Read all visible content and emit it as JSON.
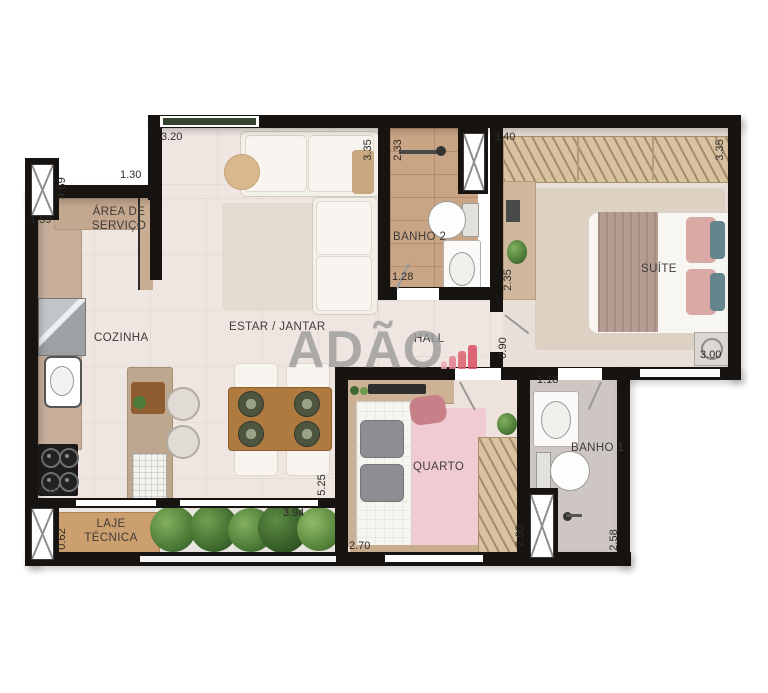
{
  "watermark": {
    "text": "ADÃO",
    "logo": "bar-chart-logo"
  },
  "rooms": {
    "area_servico": "ÁREA DE SERVIÇO",
    "cozinha": "COZINHA",
    "estar_jantar": "ESTAR / JANTAR",
    "hall": "HALL",
    "banho2": "BANHO 2",
    "suite": "SUÍTE",
    "quarto": "QUARTO",
    "banho1": "BANHO 1",
    "laje_tecnica": "LAJE TÉCNICA"
  },
  "dims": {
    "estar_top": "3.20",
    "servico_top": "1.30",
    "servico_left_v": "4.69",
    "servico_left": "1.59",
    "banho2_left_v": "2.33",
    "estar_right_v": "3.35",
    "suite_top": "3.40",
    "suite_right_v": "3.35",
    "banho2_bottom": "1.28",
    "suite_left_v": "2.35",
    "hall_v": "0.90",
    "suite_bottom": "3.00",
    "banho1_top": "1.18",
    "cozinha_bottom": "4.19",
    "jantar_right_v": "5.25",
    "varanda_top": "3.94",
    "laje_left_v": "0.62",
    "quarto_bottom": "2.70",
    "quarto_right_v": "2.60",
    "banho1_right_v": "2.58"
  },
  "colors": {
    "wall": "#171310",
    "watermark_gray": "#9C9C9C",
    "logo_bars": [
      "#ECAAB1",
      "#E5818E",
      "#DE5F70",
      "#D94E62"
    ],
    "quarto_rug_pink": "#F1CBD2",
    "wood_floor": "#C9A585"
  }
}
